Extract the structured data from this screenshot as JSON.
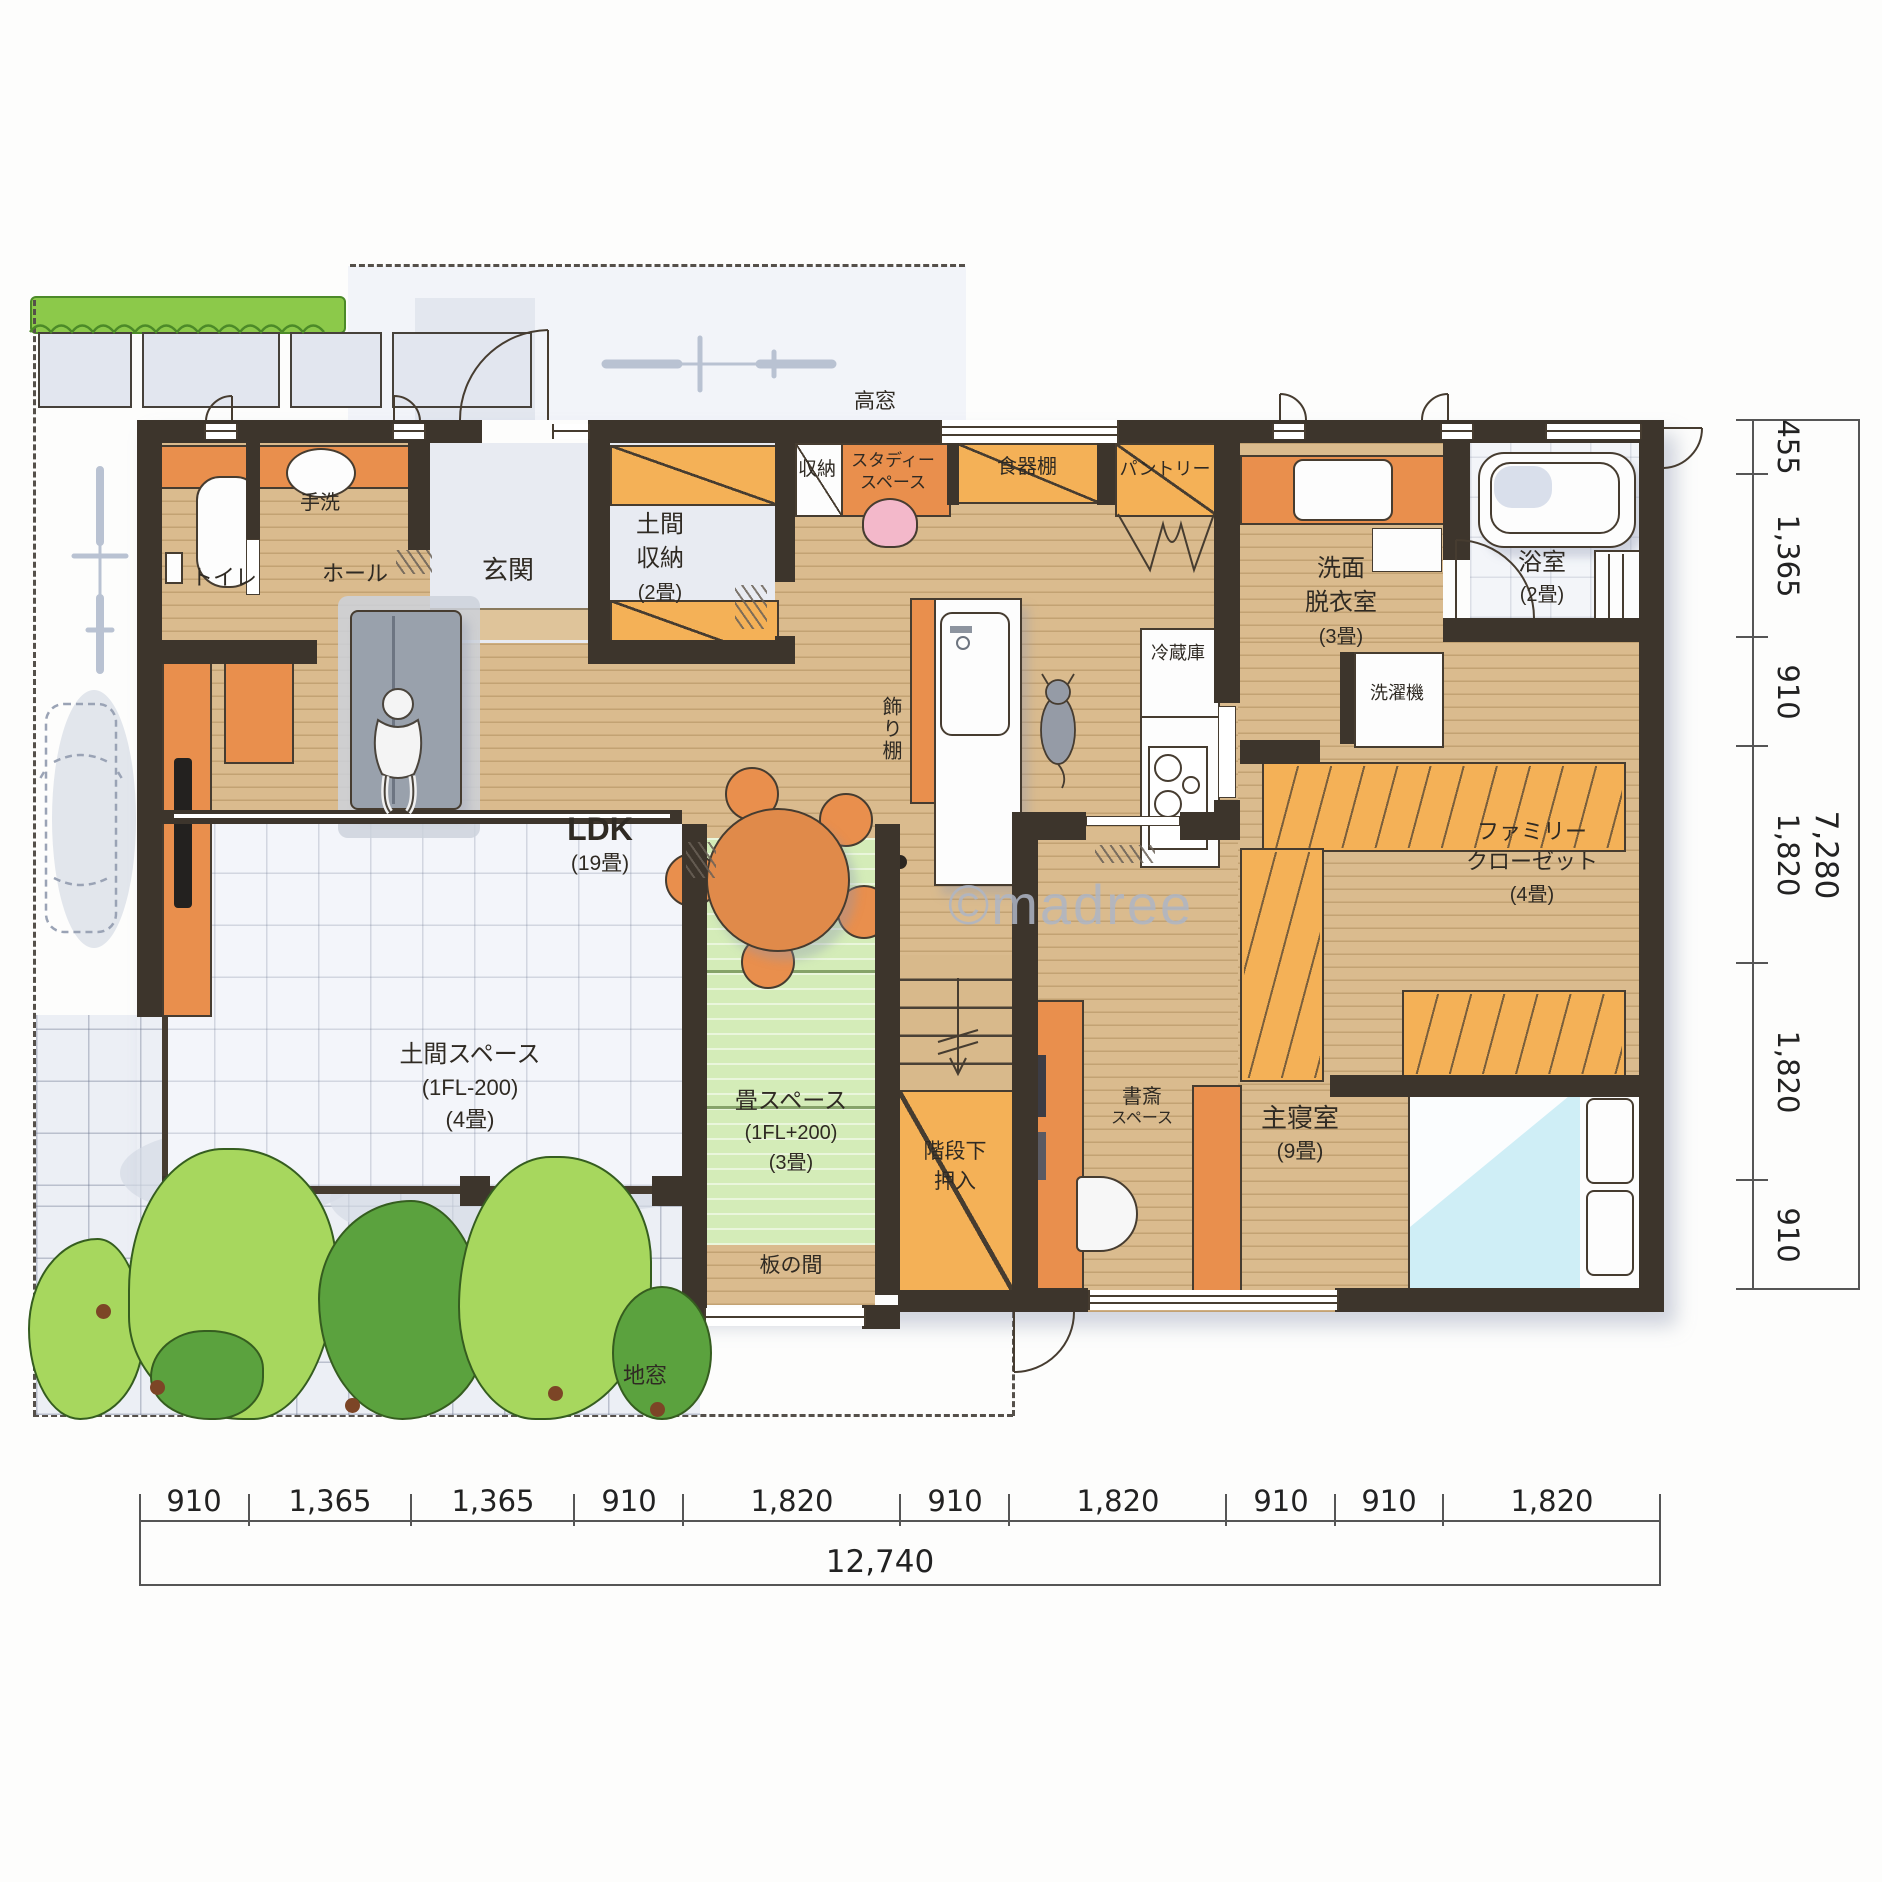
{
  "watermark": "©madree",
  "labels": {
    "toilet": "トイレ",
    "handwash": "手洗",
    "hall": "ホール",
    "entrance": "玄関",
    "doma_storage_l1": "土間",
    "doma_storage_l2": "収納",
    "doma_storage_size": "(2畳)",
    "closet_small": "収納",
    "study_nook_l1": "スタディー",
    "study_nook_l2": "スペース",
    "high_window": "高窓",
    "dish_cabinet": "食器棚",
    "pantry": "パントリー",
    "washroom_l1": "洗面",
    "washroom_l2": "脱衣室",
    "washroom_size": "(3畳)",
    "bathroom": "浴室",
    "bathroom_size": "(2畳)",
    "washing_machine": "洗濯機",
    "refrigerator": "冷蔵庫",
    "display_shelf": "飾り棚",
    "ldk": "LDK",
    "ldk_size": "(19畳)",
    "family_closet_l1": "ファミリー",
    "family_closet_l2": "クローゼット",
    "family_closet_size": "(4畳)",
    "doma_space": "土間スペース",
    "doma_space_level": "(1FL-200)",
    "doma_space_size": "(4畳)",
    "tatami_space": "畳スペース",
    "tatami_space_level": "(1FL+200)",
    "tatami_space_size": "(3畳)",
    "itanoma": "板の間",
    "jimado": "地窓",
    "under_stairs_l1": "階段下",
    "under_stairs_l2": "押入",
    "study_space_l1": "書斎",
    "study_space_l2": "スペース",
    "master_bedroom": "主寝室",
    "master_bedroom_size": "(9畳)"
  },
  "dimensions": {
    "bottom": {
      "segments": [
        "910",
        "1,365",
        "1,365",
        "910",
        "1,820",
        "910",
        "1,820",
        "910",
        "910",
        "1,820"
      ],
      "total": "12,740"
    },
    "right": {
      "segments": [
        "455",
        "1,365",
        "910",
        "1,820",
        "1,820",
        "910"
      ],
      "total": "7,280"
    }
  },
  "colors": {
    "wall": "#3d352c",
    "wood_floor": "#dabb8e",
    "tatami": "#d4ecb8",
    "cabinet": "#f4b157",
    "accent_orange": "#e98f4d",
    "tile": "#eceff5",
    "greenery_light": "#a7d75e",
    "greenery_dark": "#5ba23e",
    "watermark": "#aeb6c6"
  }
}
